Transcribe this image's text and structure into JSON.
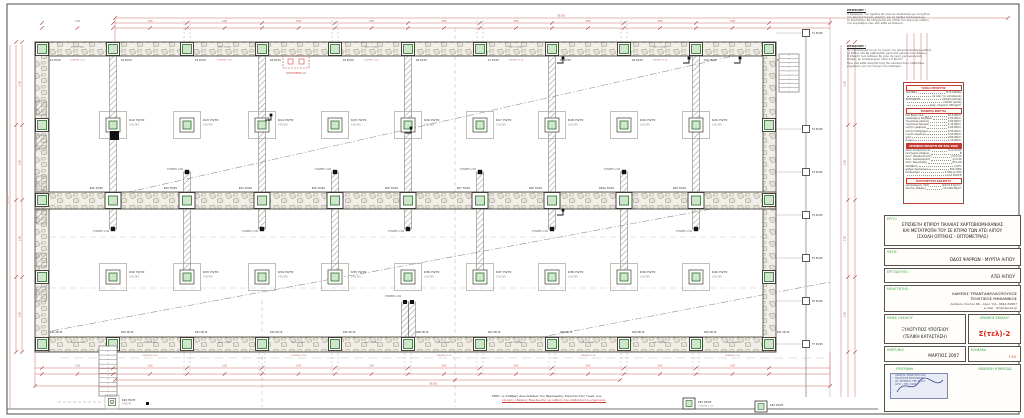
{
  "colors": {
    "dim": "#c76a66",
    "dim_text": "#b04f4a",
    "line": "#444444",
    "hatch": "#8f8f8f",
    "column_green": "#cfe6cc",
    "column_green_stroke": "#3f7a3c",
    "accent_red": "#d42a1e",
    "label_green": "#2ea03c"
  },
  "titleblock": {
    "project_label": "ΕΡΓΟ:",
    "project_lines": [
      "ΕΠΙΣΚΕΥΗ ΚΤΙΡΙΟΥ ΠΑΛΑΙΑΣ ΧΑΡΤΟΒΙΟΜΗΧΑΝΙΑΣ",
      "ΚΑΙ ΜΕΤΑΤΡΟΠΗ ΤΟΥ ΣΕ ΚΤΙΡΙΟ ΤΩΝ ΑΤΕΙ ΑΙΓΙΟΥ",
      "(ΣΧΟΛΗ ΟΠΤΙΚΗΣ - ΟΠΤΟΜΕΤΡΙΑΣ)"
    ],
    "location_label": "ΘΕΣΗ:",
    "location": "ΟΔΟΣ ΨΑΡΡΩΝ - ΜΥΡΤΙΑ ΑΙΓΙΟΥ",
    "client_label": "ΕΡΓΟΔΟΤΗΣ:",
    "client": "ΑΤΕΙ ΑΙΓΙΟΥ",
    "engineer_label": "ΜΕΛΕΤΗΤΗΣ:",
    "engineer_lines": [
      "ΛΑΜΠΗΣ ΤΡΙΑΝΤΑΦΥΛΛΟΠΟΥΛΟΣ",
      "ΠΟΛΙΤΙΚΟΣ ΜΗΧΑΝΙΚΟΣ",
      "Ανδρέου Λόντου 66 - Αίγιο   τηλ. 0691-61867",
      "e-mail : ltri@otenet.gr"
    ],
    "subject_label": "ΘΕΜΑ ΣΧΕΔΙΟΥ",
    "subject_lines": [
      "ΞΥΛΟΤΥΠΟΣ ΥΠΟΓΕΙΟΥ",
      "(ΤΕΛΙΚΗ ΚΑΤΑΣΤΑΣΗ)"
    ],
    "number_label": "ΑΡΙΘΜΟΣ ΣΧΕΔΙΟΥ",
    "number": "Σ(τελ)-2",
    "date_label": "ΗΜΕΡ/ΝΙΑ",
    "date": "ΜΑΡΤΙΟΣ 2007",
    "scale_label": "ΚΛΙΜΑΚΑ",
    "scale": "1:50",
    "signature_label": "ΥΠΟΓΡΑΦΗ",
    "approval_label": "ΘΕΩΡΗΣΗ ΥΠΗΡΕΣΙΑΣ",
    "stamp_lines": [
      "ΛΑΜΠΗΣ ΤΡΙΑΝΤ/ΠΟΥΛΟΣ",
      "ΠΟΛΙΤΙΚΟΣ ΜΗΧΑΝΙΚΟΣ",
      "ΑΡ. ΜΗΤΡΩΟΥ ΤΕΕ 48112",
      "ΑΙΓΙΟ - ΤΗΛ. 61867"
    ]
  },
  "notes": [
    {
      "title": "ΠΡΟΣΟΧΗ :",
      "lines": [
        "Η εφαρμογή του σχεδίου θα γίνει σε συνδυασμό με τα σχέδια",
        "της αρχιτεκτονικής μελέτης και τα σχέδια λεπτομερειών.",
        "Οι διαστάσεις θα ελέγχονται επί τόπου του έργου με ευθύνη",
        "του εργολάβου πριν από κάθε κατασκευή."
      ]
    },
    {
      "title": "ΠΡΟΣΟΧΗ :",
      "lines": [
        "Τα υποστυλώματα και τα τοιχία του υπογείου θα θεμελιωθούν",
        "σε βάθος που θα καθορισθεί μετά από έρευνα του εδάφους.",
        "Η έδραση των πεδίλων θα γίνει σε υγιές και ομοιογενές",
        "έδαφος με επιτρεπόμενη τάση 2.0 kp/cm².",
        "Πριν από κάθε σκυροδέτηση θα ειδοποιείται ο επιβλέπων",
        "μηχανικός για τον έλεγχο του οπλισμού."
      ]
    }
  ],
  "spec_table": {
    "sections": [
      {
        "header": "ΥΛΙΚΑ ΜΕΛΕΤΗΣ",
        "fill": false,
        "rows": [
          [
            "ΧΑΛΥΒΑΣ",
            "St III (S400s)"
          ],
          [
            "",
            "σε όλες τις κατασκευές"
          ],
          [
            "ΣΚΥΡΟΔΕΜΑ",
            "C16/20 (πέδιλα)"
          ],
          [
            "",
            "C20/25 (λοιπά)"
          ],
          [
            "",
            "ελάχ. τσιμέντο 330 kg/m³"
          ]
        ]
      },
      {
        "header": "ΜΟΝΙΜΑ ΦΟΡΤΙΑ",
        "fill": false,
        "rows": [
          [
            "ίδιο βάρος Ω.Σ.",
            "25.0 kN/m³"
          ],
          [
            "επικαλύψεις δαπέδων",
            "2.00 kN/m²"
          ],
          [
            "τοιχοποιία μπατική",
            "3.60 kN/m²"
          ],
          [
            "τοιχοποιία δρομική",
            "2.10 kN/m²"
          ],
          [
            "κινητό γραφείων",
            "2.00 kN/m²"
          ],
          [
            "κινητό διαδρόμων",
            "5.00 kN/m²"
          ],
          [
            "κινητό κλιμάκων",
            "5.00 kN/m²"
          ],
          [
            "χιόνι",
            "0.60 kN/m²"
          ],
          [
            "άνεμος",
            "1.10 kN/m²"
          ]
        ]
      },
      {
        "header": "ΣΕΙΣΜΙΚΗ ΜΕΛΕΤΗ ΜΕ ΕΑΚ 2000",
        "fill": true,
        "rows": [
          [
            "ζώνη σεισμικότητας",
            "ΙΙ (α=0.24)"
          ],
          [
            "κατηγορία εδάφους",
            "Β"
          ],
          [
            "συντ. σπουδαιότητας",
            "γ1=1.15"
          ],
          [
            "συντ. συμπεριφοράς",
            "q=3.50"
          ],
          [
            "συντ. θεμελίωσης",
            "θ=1.00"
          ],
          [
            "απόσβεση",
            "ζ=5%"
          ],
          [
            "φάσμα σχεδιασμού",
            "ΕΑΚ 2000"
          ],
          [
            "συνδυασμοί",
            "1.35G+1.50Q"
          ],
          [
            "",
            "G+0.30Q±E"
          ]
        ]
      },
      {
        "header": "ΠΑΡΑΜΕΤΡΟΙ ΕΔΑΦΟΥΣ",
        "fill": false,
        "rows": [
          [
            "επιτρεπόμενη τάση",
            "σεπ=2.0 kp/cm²"
          ],
          [
            "δείκτης εδάφους",
            "Ks=300 Mp/m³"
          ]
        ]
      }
    ]
  },
  "plan": {
    "grid_x": [
      42,
      113,
      187,
      262,
      335,
      408,
      480,
      552,
      624,
      696,
      769
    ],
    "wall_texts": {
      "senaz": "4Φ12 ΣΕΝΑΖ",
      "level": "ΣΤΑΘΜΗ -0.05"
    },
    "stub_label": "ΣΤΑΘΜΗ -2.60",
    "dims": {
      "top_total": "36.50",
      "seg": "3.65",
      "left_total": "11.15",
      "left_seg": "3.80",
      "bottom_total": "36.50"
    },
    "columns": {
      "top": [
        "K1",
        "K2",
        "K3",
        "K4",
        "K5",
        "K6",
        "K7",
        "K8",
        "K9",
        "K10",
        "K11"
      ],
      "row2": [
        "K12",
        "K13",
        "K14",
        "K15",
        "K16",
        "K17",
        "K18",
        "K19",
        "K20"
      ],
      "strip": [
        "K21",
        "K22",
        "K23",
        "K24",
        "K25",
        "K26",
        "K27",
        "K28",
        "K29α",
        "K30",
        "K31"
      ],
      "row4": [
        "K32",
        "K33",
        "K34",
        "K35",
        "K36",
        "K37",
        "K38",
        "K39",
        "K40"
      ],
      "bottom": [
        "K41",
        "K42",
        "K43",
        "K44",
        "K45",
        "K46",
        "K47",
        "K48",
        "K49",
        "K50",
        "K51"
      ],
      "right_ext": [
        "Τ1",
        "Τ2",
        "Τ3",
        "Τ4",
        "Τ5",
        "Τ6",
        "Τ7"
      ],
      "wall_size": "25/70",
      "footing_size": "70/70",
      "footing_base": "140/140",
      "strip_size": "70/25",
      "ext_size": "25/25"
    },
    "extra_footing": {
      "name": "Κ29",
      "size": "70/70",
      "base": "140/140"
    },
    "legend": [
      {
        "name": "Κ52",
        "size": "25/25"
      },
      {
        "name": "Κ53",
        "size": "25/25"
      }
    ],
    "detail_callout": "ΛΕΠΤΟΜΕΡΕΙΑ Δ1",
    "bottom_note": {
      "black": "ΣΗΜ.: οι στάθμες άνω πεδίλων της θεμελίωσης δίνονται στις τομές α-α.",
      "red": "έλεγχος εδάφους θεμελίωσης με ευθύνη του επιβλέποντα μηχανικού."
    }
  }
}
